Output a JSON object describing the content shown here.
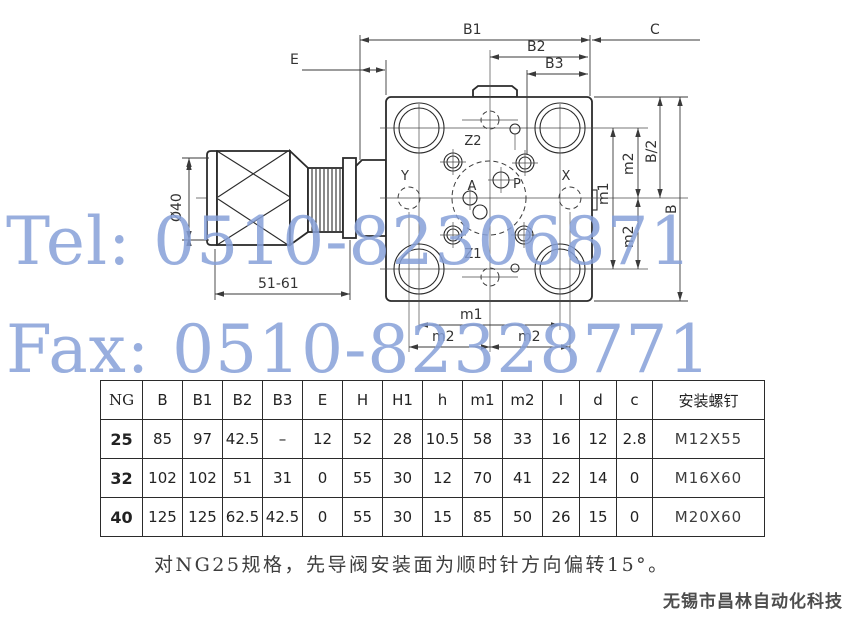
{
  "watermark": {
    "line1": "Tel: 0510-82306871",
    "line2": "Fax: 0510-82328771",
    "color": "#86a0d8"
  },
  "drawing": {
    "labels": {
      "b1": "B1",
      "b2": "B2",
      "b3": "B3",
      "c": "C",
      "e": "E",
      "dia40": "Ø40",
      "travel": "51-61",
      "m1_bottom": "m1",
      "m2_bottom_left": "m2",
      "m2_bottom_right": "m2",
      "m1_right": "m1",
      "m2_right_upper": "m2",
      "m2_right_lower": "m2",
      "b_half": "B/2",
      "b": "B",
      "z2": "Z2",
      "z1": "Z1",
      "y": "Y",
      "x": "X",
      "a": "A",
      "p": "P"
    },
    "line_color": "#2b2b2b"
  },
  "table": {
    "headers": [
      "NG",
      "B",
      "B1",
      "B2",
      "B3",
      "E",
      "H",
      "H1",
      "h",
      "m1",
      "m2",
      "I",
      "d",
      "c",
      "安装螺钉"
    ],
    "rows": [
      [
        "25",
        "85",
        "97",
        "42.5",
        "–",
        "12",
        "52",
        "28",
        "10.5",
        "58",
        "33",
        "16",
        "12",
        "2.8",
        "M12X55"
      ],
      [
        "32",
        "102",
        "102",
        "51",
        "31",
        "0",
        "55",
        "30",
        "12",
        "70",
        "41",
        "22",
        "14",
        "0",
        "M16X60"
      ],
      [
        "40",
        "125",
        "125",
        "62.5",
        "42.5",
        "0",
        "55",
        "30",
        "15",
        "85",
        "50",
        "26",
        "15",
        "0",
        "M20X60"
      ]
    ]
  },
  "note": "对NG25规格，先导阀安装面为顺时针方向偏转15°。",
  "footer": "无锡市昌林自动化科技"
}
